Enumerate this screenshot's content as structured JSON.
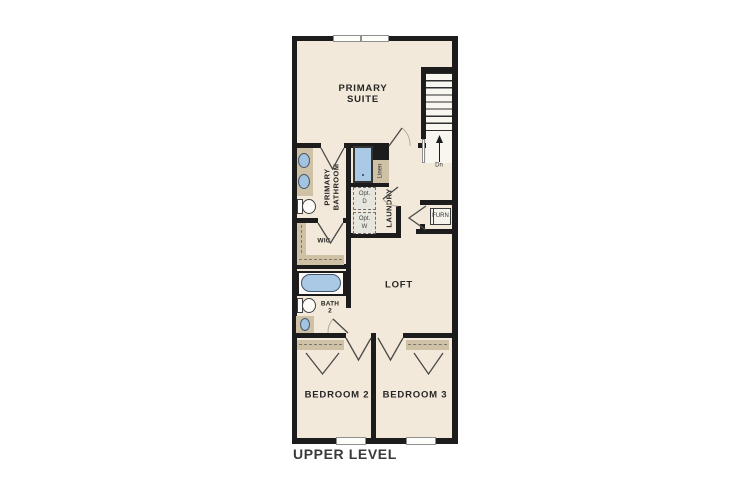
{
  "plan": {
    "title": "UPPER LEVEL",
    "colors": {
      "floor": "#f2e9da",
      "wall": "#1c1c1c",
      "casework_tan": "#cfc1a6",
      "fixture_blue": "#aac9e4",
      "label_text": "#2b2b2b"
    },
    "rooms": {
      "primary_suite": {
        "line1": "PRIMARY",
        "line2": "SUITE"
      },
      "primary_bathroom": {
        "line1": "PRIMARY",
        "line2": "BATHROOM"
      },
      "wic": {
        "label": "WIC"
      },
      "linen": {
        "label": "Linen"
      },
      "laundry": {
        "label": "LAUNDRY"
      },
      "loft": {
        "label": "LOFT"
      },
      "bath2": {
        "line1": "BATH",
        "line2": "2"
      },
      "bedroom2": {
        "label": "BEDROOM 2"
      },
      "bedroom3": {
        "label": "BEDROOM 3"
      },
      "furnace_closet": {
        "label": "FURN"
      }
    },
    "appliances": {
      "opt_dryer": {
        "line1": "Opt.",
        "line2": "D"
      },
      "opt_washer": {
        "line1": "Opt.",
        "line2": "W"
      }
    },
    "stairs": {
      "direction_label": "Dn"
    }
  }
}
